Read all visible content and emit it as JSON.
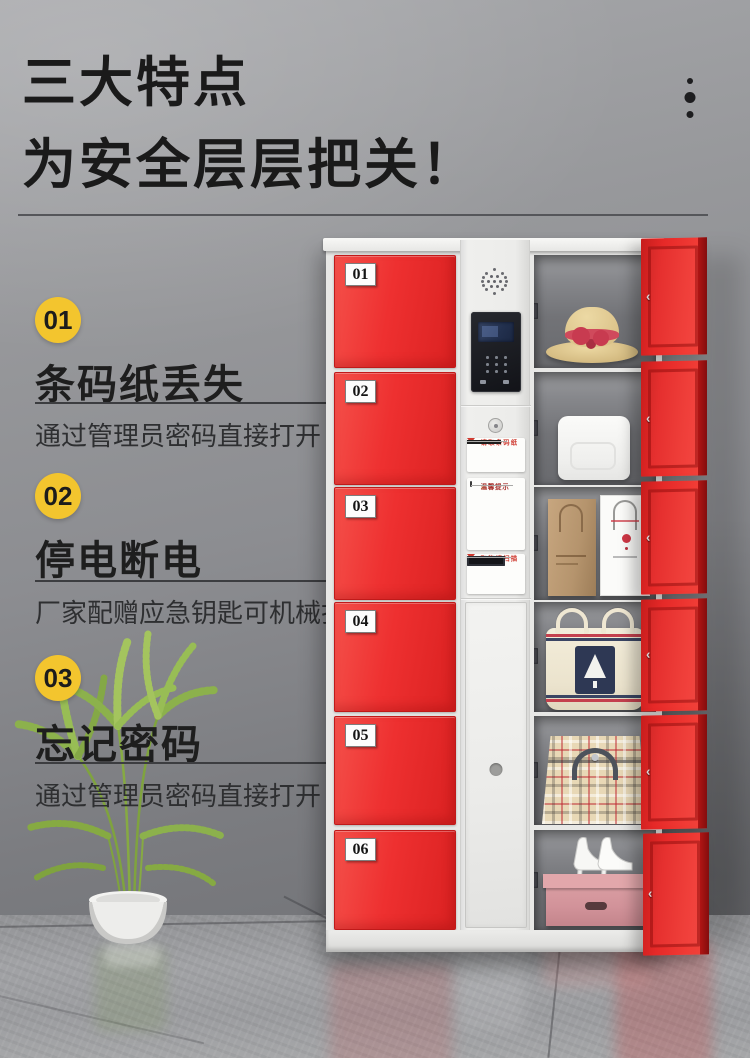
{
  "header": {
    "title_line1": "三大特点",
    "title_line2": "为安全层层把关！"
  },
  "features": [
    {
      "num": "01",
      "title": "条码纸丢失",
      "desc": "通过管理员密码直接打开"
    },
    {
      "num": "02",
      "title": "停电断电",
      "desc": "厂家配赠应急钥匙可机械打开"
    },
    {
      "num": "03",
      "title": "忘记密码",
      "desc": "通过管理员密码直接打开"
    }
  ],
  "locker": {
    "doors": [
      "01",
      "02",
      "03",
      "04",
      "05",
      "06"
    ],
    "panel": {
      "sticker1_title": "请取条码纸",
      "warning_title": "温馨提示",
      "sticker2_title": "取物请扫描"
    },
    "compartment_items": [
      "straw-hat-with-red-bow",
      "white-storage-box",
      "paper-shopping-bags",
      "canvas-tote-bag",
      "plaid-handbag",
      "high-heels-on-pink-storage-box"
    ]
  },
  "icons": {
    "warning": "⚠",
    "latch": "‹"
  },
  "colors": {
    "door_red": "#ee2b2b",
    "accent_yellow": "#f3c52e",
    "title_black": "#1a1a1a"
  }
}
